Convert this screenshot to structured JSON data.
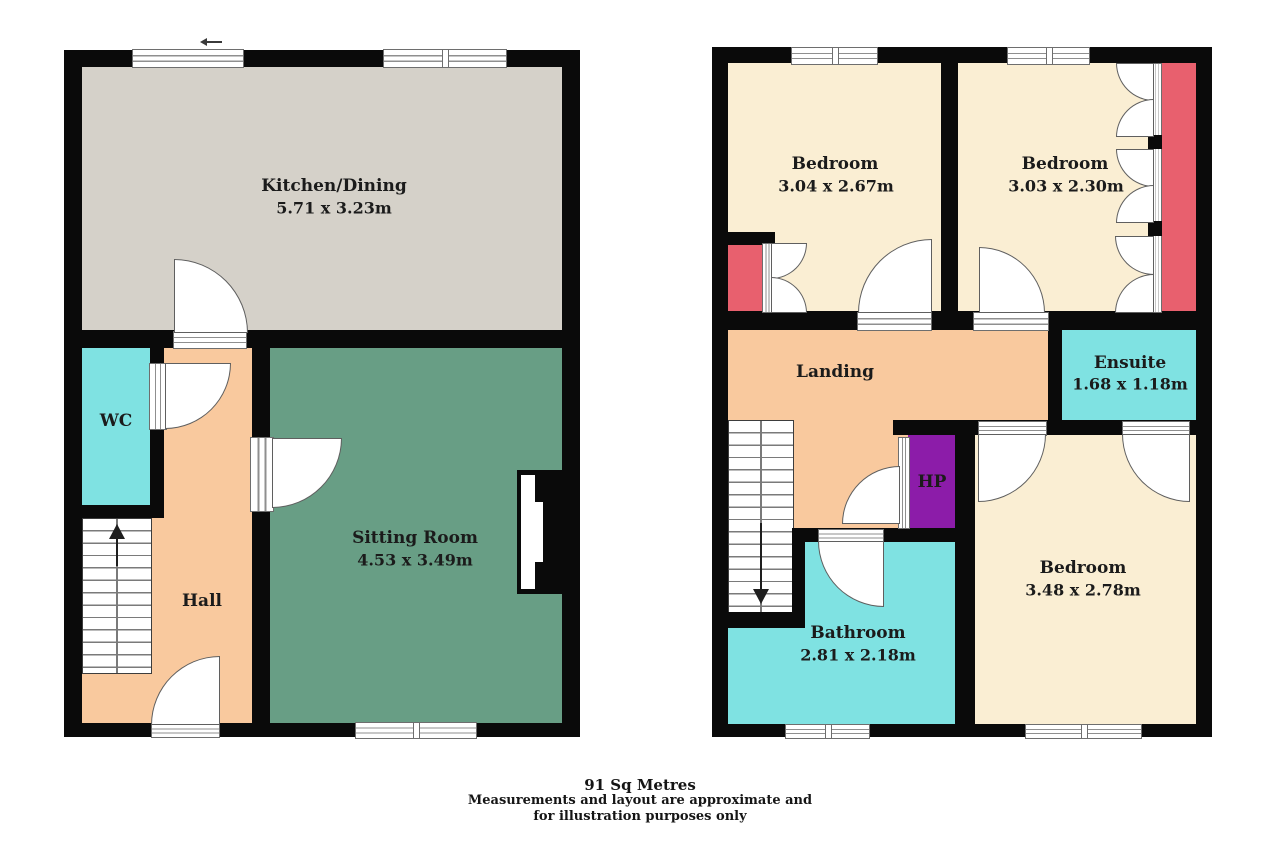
{
  "ground_floor": {
    "kitchen": {
      "name": "Kitchen/Dining",
      "dims": "5.71 x 3.23m"
    },
    "wc": {
      "name": "WC"
    },
    "hall": {
      "name": "Hall"
    },
    "sitting_room": {
      "name": "Sitting Room",
      "dims": "4.53 x 3.49m"
    }
  },
  "first_floor": {
    "bedroom_front_left": {
      "name": "Bedroom",
      "dims": "3.04 x 2.67m"
    },
    "bedroom_front_right": {
      "name": "Bedroom",
      "dims": "3.03 x 2.30m"
    },
    "landing": {
      "name": "Landing"
    },
    "ensuite": {
      "name": "Ensuite",
      "dims": "1.68 x 1.18m"
    },
    "hot_press": {
      "name": "HP"
    },
    "bedroom_back": {
      "name": "Bedroom",
      "dims": "3.48 x 2.78m"
    },
    "bathroom": {
      "name": "Bathroom",
      "dims": "2.81 x 2.18m"
    }
  },
  "footer": {
    "area": "91 Sq Metres",
    "disclaimer_line1": "Measurements and layout are approximate and",
    "disclaimer_line2": "for illustration purposes only"
  },
  "colors": {
    "wall": "#0a0a0a",
    "kitchen-floor": "#d5d1c9",
    "sitting-floor": "#689e85",
    "hall-floor": "#f9c99e",
    "wet-floor": "#7fe2e2",
    "bedroom-floor": "#faeed3",
    "wardrobe": "#e8606e",
    "hot-press": "#8c1ca9",
    "label-text": "#1b1b1b"
  }
}
